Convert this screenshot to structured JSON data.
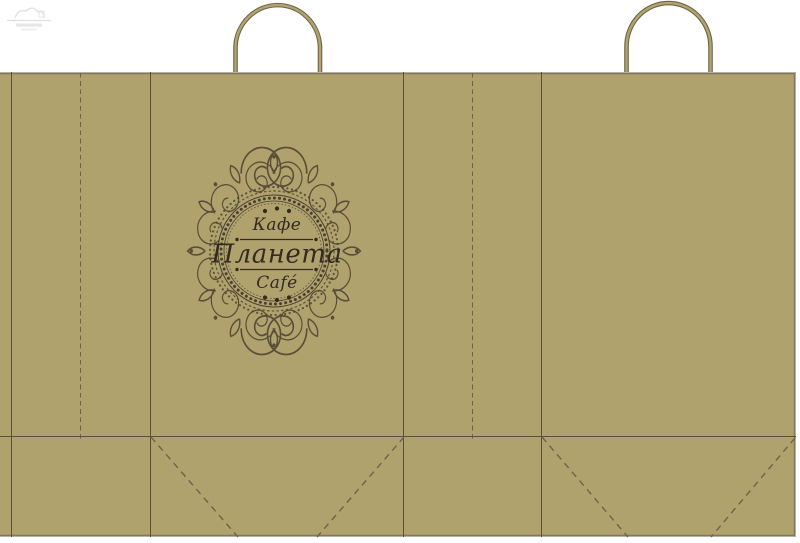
{
  "artboard": {
    "description": "paper shopping bag die-line mockup",
    "background": "#ffffff",
    "watermark_visible": true
  },
  "bag": {
    "fill": "#b0a26d",
    "cut_edge_color": "#b3b0a8",
    "solid_fold_color": "#59523a",
    "dashed_fold_color": "#6d6349"
  },
  "handles": {
    "outer_stroke": "#6e6446",
    "inner_stroke": "#b2a470"
  },
  "logo": {
    "top_word": "Кафе",
    "main_word": "Планета",
    "bottom_word": "Café",
    "ink": "#332b21",
    "ornament_color": "#4a4131"
  }
}
